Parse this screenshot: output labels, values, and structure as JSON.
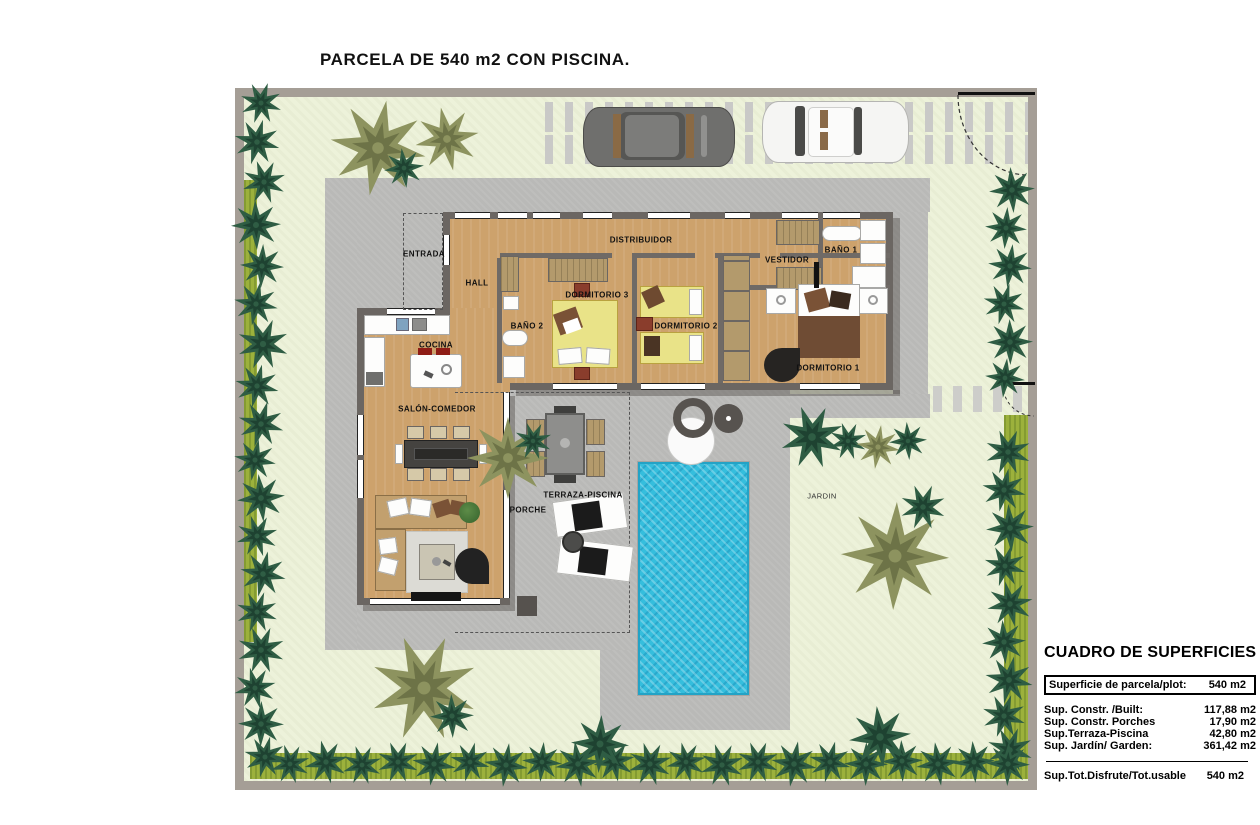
{
  "title": "PARCELA DE 540 m2 CON PISCINA.",
  "rooms": {
    "entrada": "ENTRADA",
    "hall": "HALL",
    "distribuidor": "DISTRIBUIDOR",
    "bano2": "BAÑO 2",
    "dormitorio3": "DORMITORIO 3",
    "dormitorio2": "DORMITORIO 2",
    "dormitorio1": "DORMITORIO 1",
    "vestidor": "VESTIDOR",
    "bano1": "BAÑO 1",
    "cocina": "COCINA",
    "salon": "SALÓN-COMEDOR",
    "porche": "PORCHE",
    "terraza": "TERRAZA-PISCINA",
    "jardin": "JARDIN"
  },
  "surface_table": {
    "title": "CUADRO DE SUPERFICIES",
    "plot_row": {
      "label": "Superficie de parcela/plot:",
      "value": "540 m2"
    },
    "rows": [
      {
        "label": "Sup. Constr. /Built:",
        "value": "117,88 m2"
      },
      {
        "label": "Sup. Constr. Porches",
        "value": "17,90 m2"
      },
      {
        "label": "Sup.Terraza-Piscina",
        "value": "42,80 m2"
      },
      {
        "label": "Sup. Jardín/ Garden:",
        "value": "361,42 m2"
      }
    ],
    "total_row": {
      "label": "Sup.Tot.Disfrute/Tot.usable",
      "value": "540 m2"
    }
  },
  "colors": {
    "pool": "#35bedd",
    "lawn": "#edf2da",
    "pavement": "#b9b9b7",
    "wood_floor": "#cda26c",
    "walls": "#6b6662",
    "tree_dark": "#2f5d44",
    "tree_olive": "#8d935f",
    "hedge": "#9cb13c",
    "plot_wall": "#a59e96",
    "bed_yellow": "#e9e388",
    "car_dark": "#6f6f6d",
    "car_white": "#f5f5f3"
  }
}
